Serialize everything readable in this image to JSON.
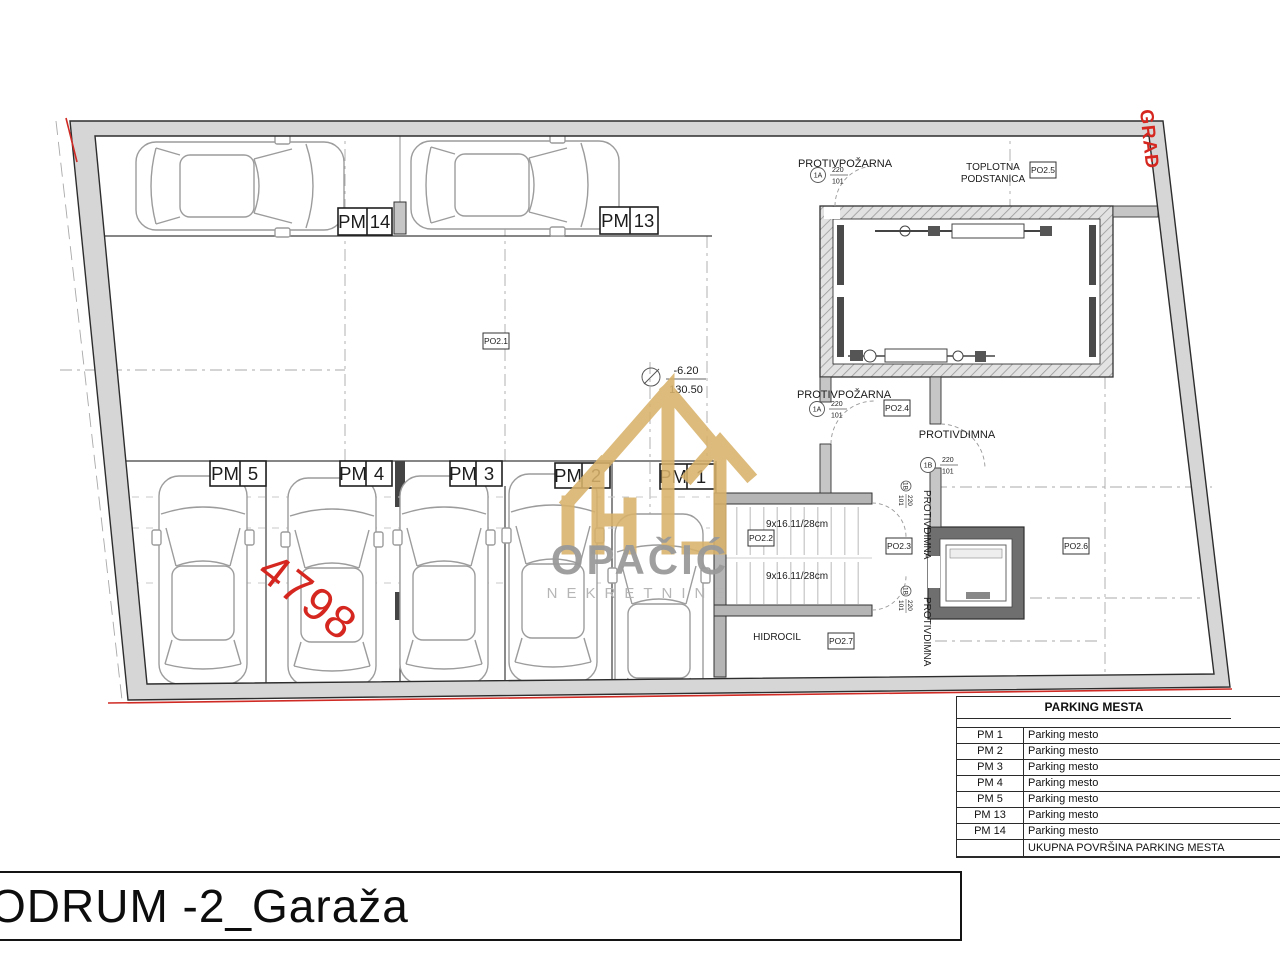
{
  "plan": {
    "spots": [
      {
        "pm": "PM",
        "num": "14"
      },
      {
        "pm": "PM",
        "num": "13"
      },
      {
        "pm": "PM",
        "num": "5"
      },
      {
        "pm": "PM",
        "num": "4"
      },
      {
        "pm": "PM",
        "num": "3"
      },
      {
        "pm": "PM",
        "num": "2"
      },
      {
        "pm": "PM",
        "num": "1"
      }
    ],
    "rooms": {
      "toplotna_line1": "TOPLOTNA",
      "toplotna_line2": "PODSTANICA",
      "hidrocil": "HIDROCIL"
    },
    "doors": {
      "fire_top": "PROTIVPOŽARNA",
      "fire_mid": "PROTIVPOŽARNA",
      "smoke_h": "PROTIVDIMNA",
      "smoke_v1": "PROTIVDIMNA",
      "smoke_v2": "PROTIVDIMNA",
      "tag_1a": "1A",
      "tag_1b": "1B",
      "dim_w": "220",
      "dim_h": "101"
    },
    "codes": {
      "po21": "PO2.1",
      "po22": "PO2.2",
      "po23": "PO2.3",
      "po24": "PO2.4",
      "po25": "PO2.5",
      "po26": "PO2.6",
      "po27": "PO2.7"
    },
    "level": {
      "relative": "-6.20",
      "absolute": "130.50"
    },
    "stairs": {
      "flight1": "9x16.11/28cm",
      "flight2": "9x16.11/28cm"
    },
    "red_number": "4798",
    "boundary_label": "GRAĐ"
  },
  "watermark": {
    "name": "OPAČIĆ",
    "subtitle": "NEKRETNINE"
  },
  "parking_table": {
    "title": "PARKING MESTA",
    "rows": [
      {
        "id": "PM 1",
        "desc": "Parking mesto"
      },
      {
        "id": "PM 2",
        "desc": "Parking mesto"
      },
      {
        "id": "PM 3",
        "desc": "Parking mesto"
      },
      {
        "id": "PM 4",
        "desc": "Parking mesto"
      },
      {
        "id": "PM 5",
        "desc": "Parking mesto"
      },
      {
        "id": "PM 13",
        "desc": "Parking mesto"
      },
      {
        "id": "PM 14",
        "desc": "Parking mesto"
      }
    ],
    "footer": "UKUPNA POVRŠINA PARKING MESTA"
  },
  "title_block": {
    "text": "ODRUM -2_Garaža"
  },
  "colors": {
    "annotation_red": "#d5271f",
    "watermark_gold": "#d8b26a"
  }
}
